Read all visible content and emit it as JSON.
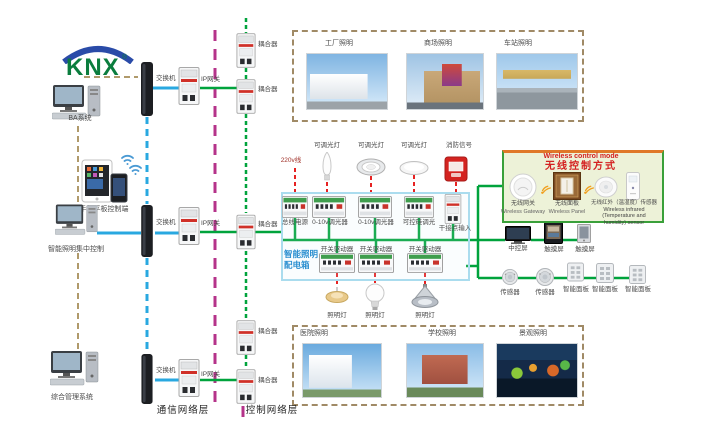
{
  "logo": {
    "text": "KNX",
    "reg": "®"
  },
  "workstations": {
    "ba": "BA系统",
    "mobile": "手机平板控制端",
    "central": "智能照明集中控制",
    "management": "综合管理系统"
  },
  "shared": {
    "switch": "交换机",
    "ip_gateway": "IP网关",
    "coupler": "耦合器",
    "dimmable_light": "可调光灯",
    "fire_signal": "消防信号",
    "power_label": "220v线",
    "switch_driver": "开关驱动器",
    "lamp": "照明灯",
    "central_screen": "中控屏",
    "touch_screen": "触摸屏",
    "sensor": "传感器",
    "smart_panel": "智能面板"
  },
  "layers": {
    "communication": "通信网络层",
    "control": "控制网络层"
  },
  "top_scenes": {
    "photos": [
      {
        "label": "工厂照明"
      },
      {
        "label": "商场照明"
      },
      {
        "label": "车站照明"
      }
    ]
  },
  "bottom_scenes": {
    "photos": [
      {
        "label": "医院照明"
      },
      {
        "label": "学校照明"
      },
      {
        "label": "景观照明"
      }
    ]
  },
  "dist_box": {
    "title_line1": "智能照明",
    "title_line2": "配电箱",
    "devices": [
      "总线电源",
      "0-10v调光器",
      "0-10v调光器",
      "可控硅调光",
      "干接点输入"
    ]
  },
  "wireless": {
    "title_en": "Wireless control mode",
    "title_zh": "无线控制方式",
    "items": [
      {
        "zh": "无线网关",
        "en": "Wireless Gateway"
      },
      {
        "zh": "无线面板",
        "en": "Wireless Panel"
      },
      {
        "zh": "无线红外（温湿度）传感器",
        "en": "Wireless infrared (Temperature and humidity) sensor"
      }
    ]
  },
  "colors": {
    "bus_green": "#00a33c",
    "comm_blue": "#29a8e0",
    "power_red": "#e62222",
    "layer_magenta": "#b5338a",
    "backbone_tan": "#b09a6b"
  }
}
